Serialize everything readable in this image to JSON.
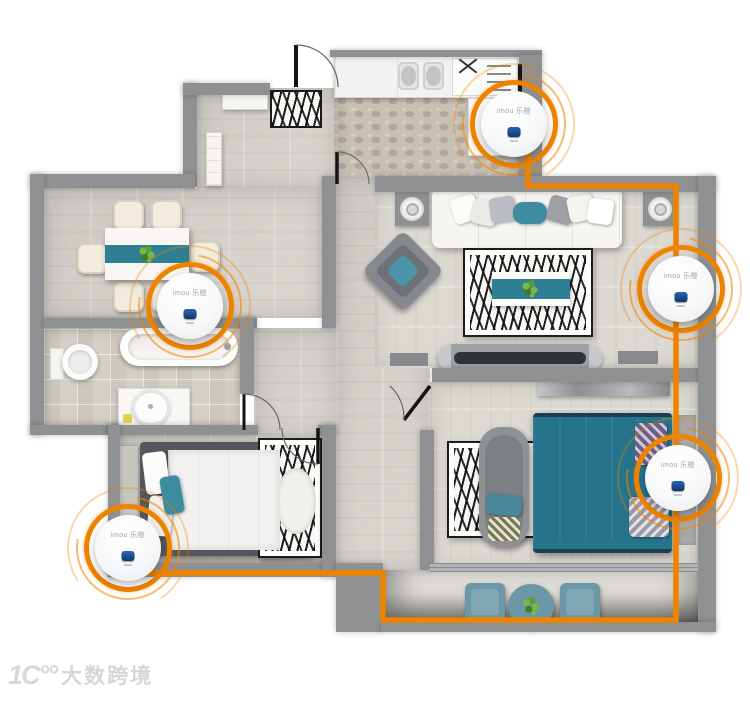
{
  "canvas": {
    "width": 750,
    "height": 706,
    "background": "#ffffff"
  },
  "palette": {
    "accent_orange": "#EE8300",
    "wall_gray": "#8F9092",
    "teal": "#2E7E94",
    "device_blue": "#1C4A8C",
    "watermark_gray": "#D9D9D9"
  },
  "devices": [
    {
      "id": "kitchen",
      "label": "imou 乐橙"
    },
    {
      "id": "dining",
      "label": "imou 乐橙"
    },
    {
      "id": "living-right",
      "label": "imou 乐橙"
    },
    {
      "id": "master-right",
      "label": "imou 乐橙"
    },
    {
      "id": "second-bedroom",
      "label": "imou 乐橙"
    }
  ],
  "watermark": {
    "logo": "1C°°",
    "text": "大数跨境"
  }
}
